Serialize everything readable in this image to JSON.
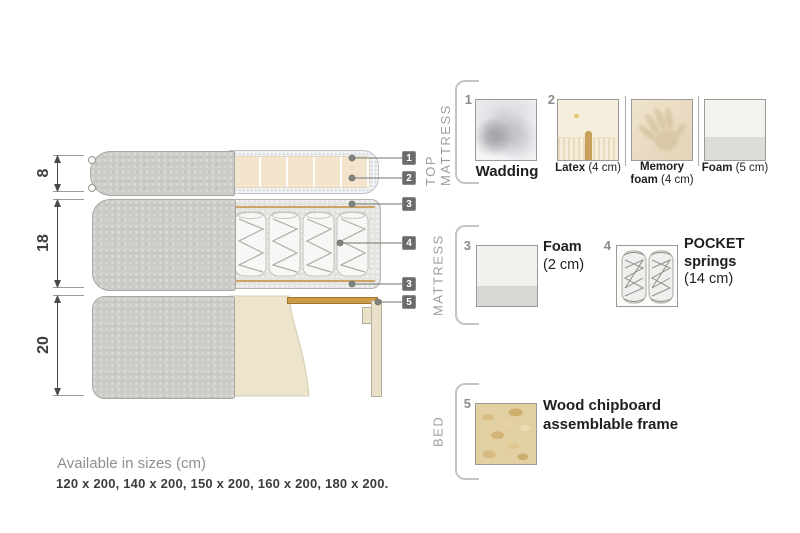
{
  "diagram": {
    "dims": [
      "8",
      "18",
      "20"
    ],
    "tags": [
      "1",
      "2",
      "3",
      "4",
      "3",
      "5"
    ]
  },
  "sections": {
    "top_mattress": {
      "label": "TOP MATTRESS",
      "wadding_num": "1",
      "wadding_label": "Wadding",
      "latex_num": "2",
      "latex_name": "Latex",
      "latex_size": " (4 cm)",
      "memory_name1": "Memory",
      "memory_name2": "foam",
      "memory_size": " (4 cm)",
      "foam_name": "Foam",
      "foam_size": " (5 cm)"
    },
    "mattress": {
      "label": "MATTRESS",
      "foam_num": "3",
      "foam_name": "Foam",
      "foam_size": "(2 cm)",
      "pocket_num": "4",
      "pocket_name1": "POCKET",
      "pocket_name2": "springs",
      "pocket_size": "(14 cm)"
    },
    "bed": {
      "label": "BED",
      "num": "5",
      "line1": "Wood chipboard",
      "line2": "assemblable frame"
    }
  },
  "footer": {
    "title": "Available in sizes (cm)",
    "sizes": "120 x 200, 140 x 200, 150 x 200, 160 x 200, 180 x 200."
  },
  "colors": {
    "cover_gray": "#cccbc7",
    "latex_cream": "#f3e5cd",
    "wadding_blue": "#dfe4e9",
    "wood_slat": "#cb9b4a",
    "chipboard": "#e3d0a2",
    "tag_gray": "#6b6b6b",
    "label_gray": "#9e9e9b",
    "text_dark": "#1f1f1d"
  }
}
